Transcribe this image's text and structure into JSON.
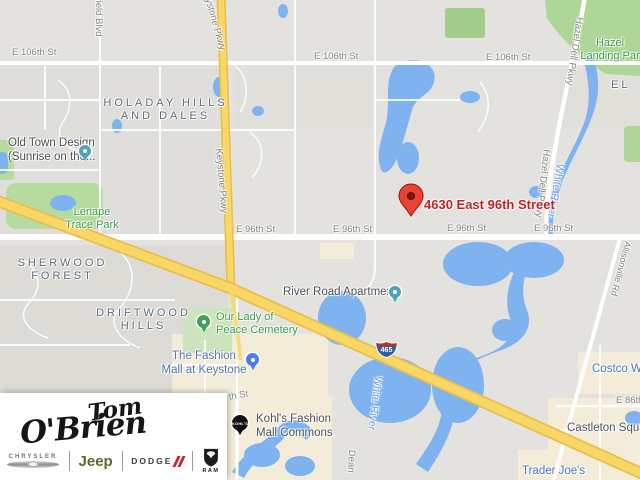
{
  "map": {
    "streets": {
      "e106th": "E 106th St",
      "e96th": "E 96th St",
      "e86th": "E 86th S",
      "keystone": "Keystone Pkwy",
      "hazel_dell": "Hazel Dell Pkwy",
      "westfield_partial": "field Blvd",
      "dean_partial": "Dean",
      "allisonville": "Allisonville Rd",
      "partial_th": "th St"
    },
    "neighborhoods": {
      "holaday": "HOLADAY HILLS\nAND DALES",
      "sherwood": "SHERWOOD\nFOREST",
      "driftwood": "DRIFTWOOD\nHILLS",
      "el_partial": "EL"
    },
    "parks": {
      "hazel_landing": "Hazel\nLanding Par",
      "lenape": "Lenape\nTrace Park",
      "cemetery": "Our Lady of\nPeace Cemetery"
    },
    "water": {
      "white_river": "White River"
    },
    "pois": {
      "old_town": "Old Town Design\n(Sunrise on the...",
      "river_road": "River Road Apartments",
      "fashion_mall": "The Fashion\nMall at Keystone",
      "kohls": "Kohl's Fashion\nMall Commons",
      "kohls_pin_text": "KOHL'S",
      "castleton": "Castleton Squa",
      "costco": "Costco Wh",
      "trader_joes": "Trader Joe's"
    },
    "destination": {
      "address": "4630 East 96th Street"
    },
    "highway_shield": {
      "number": "465"
    }
  },
  "logo": {
    "script_top": "Tom",
    "script_bottom": "O'Brien",
    "brands": {
      "chrysler": "CHRYSLER",
      "jeep": "Jeep",
      "dodge": "DODGE",
      "ram": "RAM"
    }
  },
  "colors": {
    "water": "#7eb3f0",
    "highway_yellow": "#f8d765",
    "park_green": "#aed698",
    "destination_red": "#ea4335",
    "poi_blue": "#5077ae",
    "park_label_green": "#3f9c4c",
    "dodge_red": "#c8252c",
    "jeep_green": "#5a6b2a"
  }
}
